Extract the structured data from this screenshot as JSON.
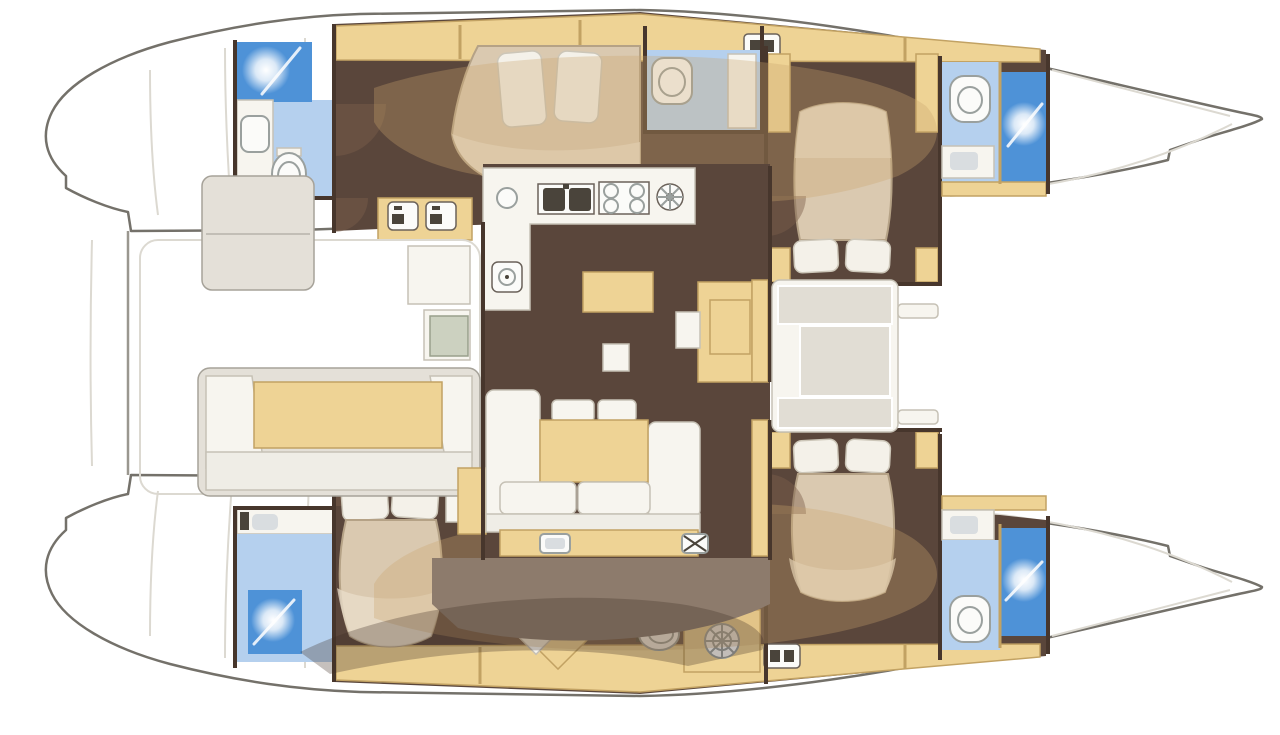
{
  "vessel": {
    "type": "catamaran-deck-plan",
    "orientation": {
      "bow": "right",
      "stern": "left"
    },
    "hulls": 2,
    "cabins": 4,
    "bathrooms": 5
  },
  "rooms": [
    {
      "id": "saloon",
      "name": "Saloon with U-shaped sofa and table"
    },
    {
      "id": "galley",
      "name": "L-shaped galley with double sink and four-burner stove"
    },
    {
      "id": "aft-cockpit",
      "name": "Aft cockpit with U-shaped bench seating"
    },
    {
      "id": "forward-cockpit",
      "name": "Forward cockpit bench"
    },
    {
      "id": "port-aft-cabin",
      "name": "Port hull aft cabin with double berth"
    },
    {
      "id": "port-aft-head",
      "name": "Port hull aft bathroom with shower"
    },
    {
      "id": "port-day-head",
      "name": "Port hull day head"
    },
    {
      "id": "port-forward-cabin",
      "name": "Port hull forward cabin with island berth"
    },
    {
      "id": "port-forward-head",
      "name": "Port hull forward bathroom with shower"
    },
    {
      "id": "starboard-aft-cabin",
      "name": "Starboard hull aft cabin with island berth"
    },
    {
      "id": "starboard-aft-head",
      "name": "Starboard hull aft bathroom with shower"
    },
    {
      "id": "starboard-passage",
      "name": "Starboard hull passage with vanity seat, WC and washing machine"
    },
    {
      "id": "starboard-forward-cabin",
      "name": "Starboard hull forward cabin with island berth"
    },
    {
      "id": "starboard-forward-head",
      "name": "Starboard hull forward bathroom with shower"
    },
    {
      "id": "foredeck",
      "name": "Foredeck between bows"
    },
    {
      "id": "stern-platforms",
      "name": "Stern platforms and transom steps"
    }
  ],
  "fixtures": [
    "shower-starburst-icon",
    "toilet-icon",
    "washbasin-icon",
    "double-sink-icon",
    "four-burner-stove-icon",
    "round-hob-icon",
    "washing-machine-icon",
    "vent-grille-icon",
    "deck-hatch-icon",
    "cool-box-icon"
  ],
  "palette": {
    "outline": "#74716a",
    "faint": "#dcd9d1",
    "wall": "#47362c",
    "floor": "#5a463b",
    "wood": "#eed395",
    "wood_border": "#c2a263",
    "bed": "#dac9b0",
    "bed_light": "#e9decb",
    "bed_border": "#b5a286",
    "pillow": "#f4f1e9",
    "pillow_border": "#ccc6b8",
    "white_fur": "#f7f5ef",
    "fur_border": "#c6c1b5",
    "gray_panel": "#e4e0d8",
    "gray_border": "#a6a299",
    "cushion": "#e1ddd4",
    "bath": "#b5d0ee",
    "shower": "#4e92d7",
    "fixture": "#fbfbf9",
    "fixture_border": "#9aa09e",
    "basin": "#4a443b",
    "sole": "#8d7b6c",
    "overlay": "rgba(202,166,110,0.32)",
    "shadow": "rgba(64,45,35,0.30)",
    "door": "rgba(124,95,75,0.45)"
  }
}
